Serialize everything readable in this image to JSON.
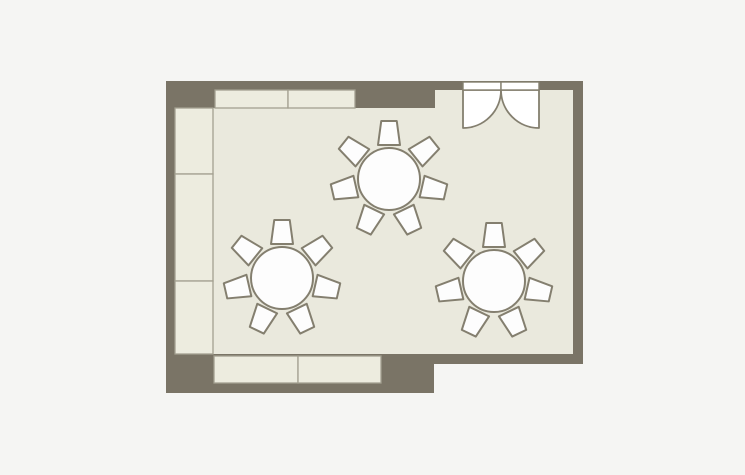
{
  "scene": {
    "kind": "floor-plan",
    "description": "Room floor plan with three round tables (7 chairs each), wall counters and a double entry door",
    "background": "#f5f5f3",
    "canvas": {
      "width": 745,
      "height": 475
    }
  },
  "colors": {
    "wall": "#7a7466",
    "floor": "#eae9dd",
    "counter_fill": "#edecdf",
    "counter_border": "#a3a090",
    "furniture_fill": "#fdfdfd",
    "furniture_border": "#847f6f",
    "door_fill": "#ffffff"
  },
  "room": {
    "footprint_points": "166,81 583,81 583,364 434,364 434,393 166,393",
    "floor": {
      "x": 175,
      "y": 90,
      "w": 398,
      "h": 264
    },
    "wall_blocks": [
      {
        "name": "wall-block-top-left",
        "x": 166,
        "y": 81,
        "w": 49,
        "h": 27
      },
      {
        "name": "wall-block-top-middle",
        "x": 355,
        "y": 81,
        "w": 80,
        "h": 27
      }
    ]
  },
  "counters": [
    {
      "name": "counter-top-1",
      "x": 215,
      "y": 90,
      "w": 73,
      "h": 18
    },
    {
      "name": "counter-top-2",
      "x": 288,
      "y": 90,
      "w": 67,
      "h": 18
    },
    {
      "name": "counter-left-1",
      "x": 175,
      "y": 108,
      "w": 38,
      "h": 66
    },
    {
      "name": "counter-left-2",
      "x": 175,
      "y": 174,
      "w": 38,
      "h": 107
    },
    {
      "name": "counter-left-3",
      "x": 175,
      "y": 281,
      "w": 38,
      "h": 73
    },
    {
      "name": "counter-bottom-1",
      "x": 214,
      "y": 356,
      "w": 84,
      "h": 27
    },
    {
      "name": "counter-bottom-2",
      "x": 298,
      "y": 356,
      "w": 83,
      "h": 27
    }
  ],
  "door": {
    "name": "double-door",
    "x": 463,
    "panel_y": 82,
    "width": 76,
    "panel_h": 8,
    "hinge_y": 90,
    "swing_radius": 38
  },
  "tables": [
    {
      "name": "round-table-1",
      "cx": 389,
      "cy": 179,
      "r": 31,
      "chairs": 7
    },
    {
      "name": "round-table-2",
      "cx": 282,
      "cy": 278,
      "r": 31,
      "chairs": 7
    },
    {
      "name": "round-table-3",
      "cx": 494,
      "cy": 281,
      "r": 31,
      "chairs": 7
    }
  ],
  "chair": {
    "front_width": 22,
    "back_width": 15.5,
    "depth": 24,
    "distance_from_table_center": 46,
    "first_angle_deg": -90,
    "missing_seat": "bottom"
  }
}
